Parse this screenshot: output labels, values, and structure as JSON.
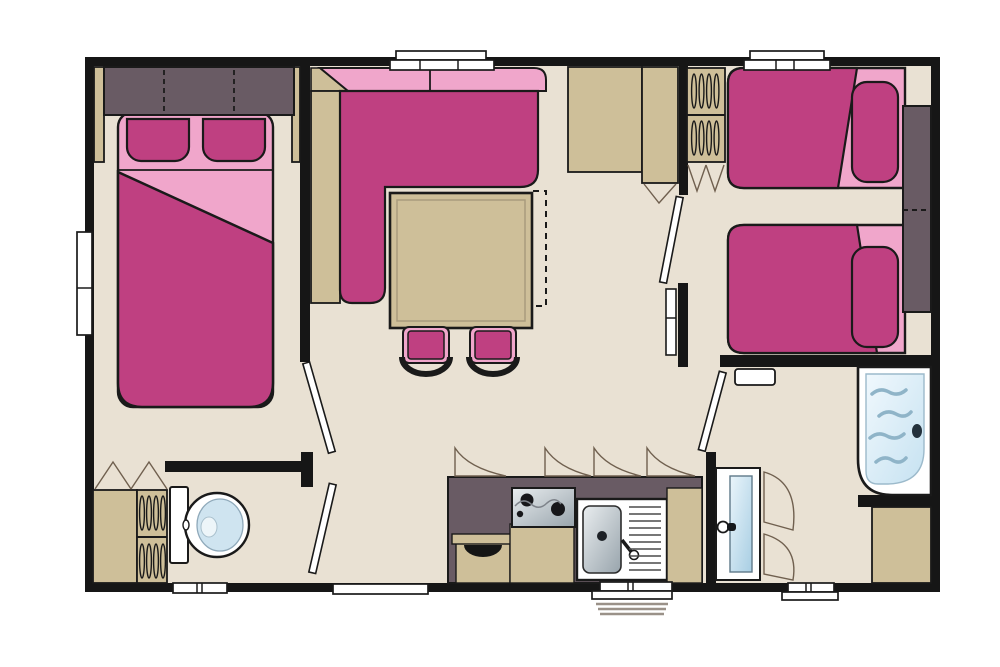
{
  "palette": {
    "floor": "#E9E1D3",
    "wall": "#161616",
    "ink": "#1A1A1A",
    "tan": "#CEBF99",
    "magenta": "#BF4081",
    "pink": "#F0A6CB",
    "cabinet": "#695B64",
    "swing": "#70604F",
    "wave": "#8FB4C8",
    "steel-1": "#E9EDEF",
    "steel-2": "#98A4AC",
    "basin-1": "#EAF5FB",
    "basin-2": "#A8CEE3",
    "tray-1": "#F0F8FD",
    "tray-2": "#C6E2F1",
    "white": "#FFFFFF"
  },
  "floorplan": {
    "type": "mobile-home-floor-plan",
    "rooms": [
      "bedroom-double",
      "living-dining",
      "kitchen",
      "wc",
      "bathroom",
      "bedroom-twin",
      "hallway"
    ],
    "furniture": [
      "double-bed",
      "overhead-wardrobe",
      "corner-sofa",
      "dining-table",
      "dining-chair",
      "dining-chair",
      "tall-cabinet",
      "tall-cabinet",
      "kitchen-counter",
      "hob",
      "sink-with-drainer",
      "toilet",
      "louvered-wardrobe",
      "louvered-wardrobe",
      "washbasin",
      "shower-tray",
      "under-shower-cabinet",
      "single-bed",
      "single-bed",
      "nightstand",
      "wall-shelf",
      "entrance-steps"
    ],
    "window_count": 7,
    "door_count": 5
  }
}
